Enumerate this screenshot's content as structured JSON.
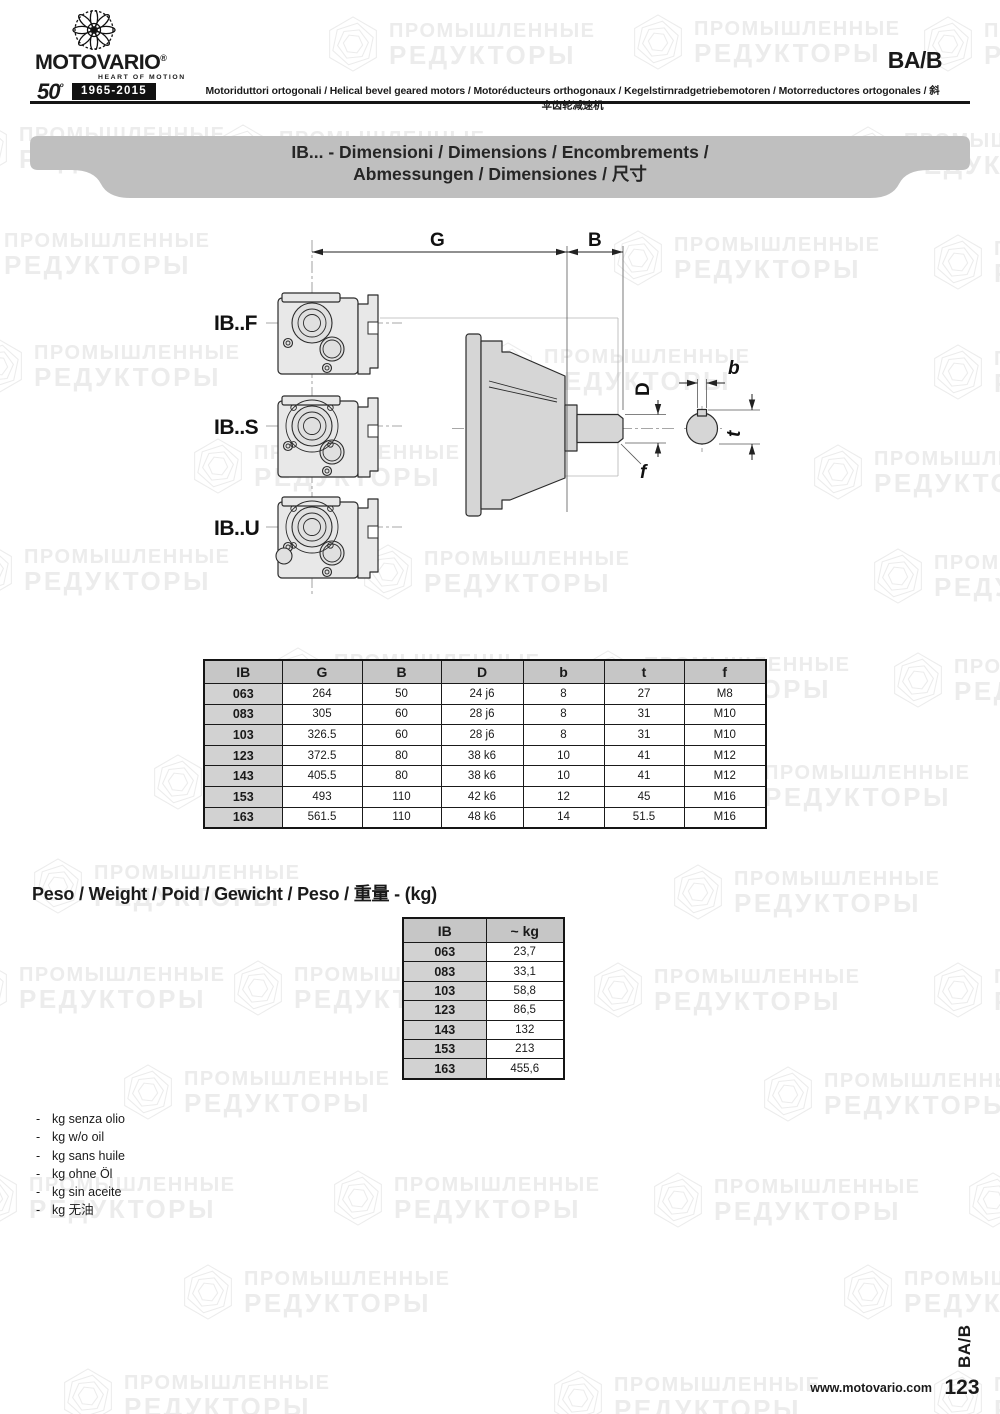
{
  "header": {
    "brand": {
      "name": "MOTOVARIO",
      "reg": "®",
      "tagline": "HEART OF MOTION",
      "anniversary_number": "50",
      "anniversary_sup": "º",
      "anniversary_years": "1965-2015"
    },
    "code": "BA/B",
    "subtitle": "Motoriduttori ortogonali / Helical bevel geared motors / Motoréducteurs orthogonaux / Kegelstirnradgetriebemotoren / Motorreductores ortogonales / 斜伞齿轮减速机"
  },
  "banner": {
    "line1": "IB... - Dimensioni / Dimensions / Encombrements /",
    "line2": "Abmessungen / Dimensiones / 尺寸",
    "bg": "#bfbfbf"
  },
  "drawing": {
    "labels": {
      "variant_f": "IB..F",
      "variant_s": "IB..S",
      "variant_u": "IB..U",
      "G": "G",
      "B": "B",
      "D": "D",
      "b": "b",
      "t": "t",
      "f": "f"
    }
  },
  "dim_table": {
    "headers": [
      "IB",
      "G",
      "B",
      "D",
      "b",
      "t",
      "f"
    ],
    "rows": [
      [
        "063",
        "264",
        "50",
        "24 j6",
        "8",
        "27",
        "M8"
      ],
      [
        "083",
        "305",
        "60",
        "28 j6",
        "8",
        "31",
        "M10"
      ],
      [
        "103",
        "326.5",
        "60",
        "28 j6",
        "8",
        "31",
        "M10"
      ],
      [
        "123",
        "372.5",
        "80",
        "38 k6",
        "10",
        "41",
        "M12"
      ],
      [
        "143",
        "405.5",
        "80",
        "38 k6",
        "10",
        "41",
        "M12"
      ],
      [
        "153",
        "493",
        "110",
        "42 k6",
        "12",
        "45",
        "M16"
      ],
      [
        "163",
        "561.5",
        "110",
        "48 k6",
        "14",
        "51.5",
        "M16"
      ]
    ]
  },
  "weight": {
    "heading": "Peso / Weight / Poid / Gewicht / Peso / 重量 - (kg)",
    "headers": [
      "IB",
      "~ kg"
    ],
    "rows": [
      [
        "063",
        "23,7"
      ],
      [
        "083",
        "33,1"
      ],
      [
        "103",
        "58,8"
      ],
      [
        "123",
        "86,5"
      ],
      [
        "143",
        "132"
      ],
      [
        "153",
        "213"
      ],
      [
        "163",
        "455,6"
      ]
    ]
  },
  "notes": {
    "bullet": "-",
    "items": [
      "kg senza olio",
      "kg w/o oil",
      "kg sans huile",
      "kg ohne Öl",
      "kg sin aceite",
      "kg 无油"
    ]
  },
  "footer": {
    "url": "www.motovario.com",
    "page": "123",
    "side_code": "BA/B"
  },
  "watermark": {
    "line1": "ПРОМЫШЛЕННЫЕ",
    "line2": "РЕДУКТОРЫ",
    "color": "#ececec",
    "positions": [
      {
        "x": 325,
        "y": 14
      },
      {
        "x": 630,
        "y": 12
      },
      {
        "x": 920,
        "y": 14
      },
      {
        "x": -45,
        "y": 118
      },
      {
        "x": 215,
        "y": 122
      },
      {
        "x": 840,
        "y": 124
      },
      {
        "x": -60,
        "y": 224
      },
      {
        "x": 610,
        "y": 228
      },
      {
        "x": 930,
        "y": 232
      },
      {
        "x": -30,
        "y": 336
      },
      {
        "x": 480,
        "y": 340
      },
      {
        "x": 930,
        "y": 342
      },
      {
        "x": 190,
        "y": 436
      },
      {
        "x": 810,
        "y": 442
      },
      {
        "x": -40,
        "y": 540
      },
      {
        "x": 360,
        "y": 542
      },
      {
        "x": 870,
        "y": 546
      },
      {
        "x": 270,
        "y": 645
      },
      {
        "x": 580,
        "y": 648
      },
      {
        "x": 890,
        "y": 650
      },
      {
        "x": 150,
        "y": 752
      },
      {
        "x": 700,
        "y": 756
      },
      {
        "x": 30,
        "y": 856
      },
      {
        "x": 670,
        "y": 862
      },
      {
        "x": -45,
        "y": 958
      },
      {
        "x": 230,
        "y": 958
      },
      {
        "x": 590,
        "y": 960
      },
      {
        "x": 930,
        "y": 960
      },
      {
        "x": 120,
        "y": 1062
      },
      {
        "x": 760,
        "y": 1064
      },
      {
        "x": -35,
        "y": 1168
      },
      {
        "x": 330,
        "y": 1168
      },
      {
        "x": 650,
        "y": 1170
      },
      {
        "x": 965,
        "y": 1170
      },
      {
        "x": 180,
        "y": 1262
      },
      {
        "x": 840,
        "y": 1262
      },
      {
        "x": 60,
        "y": 1366
      },
      {
        "x": 550,
        "y": 1368
      },
      {
        "x": 930,
        "y": 1368
      }
    ]
  }
}
